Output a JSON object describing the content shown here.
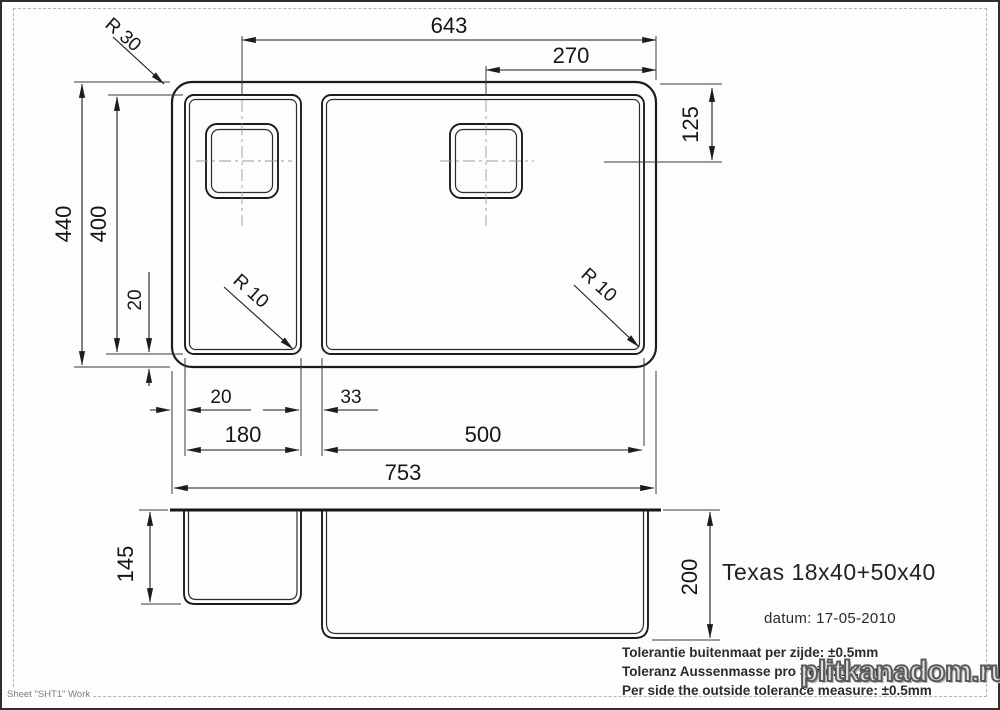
{
  "drawing": {
    "title": "Texas 18x40+50x40",
    "date_label": "datum: 17-05-2010",
    "tolerances": {
      "line_nl": "Tolerantie buitenmaat per zijde: ±0.5mm",
      "line_de": "Toleranz Aussenmasse pro Seite: ±0.5mm",
      "line_en": "Per side the outside tolerance measure: ±0.5mm"
    },
    "sheet_label": "Sheet \"SHT1\" Work",
    "watermark": "plitkanadom.ru",
    "colors": {
      "line": "#1c1c1c",
      "centerline": "#9a9a9a",
      "frame_dash": "#b5b5b5",
      "watermark_fill": "#dedede",
      "watermark_stroke": "#5a5a5a"
    },
    "dims": {
      "width_643": "643",
      "width_270": "270",
      "hole_offset_125": "125",
      "outer_depth_440": "440",
      "bowl_depth_400": "400",
      "rim_20_vertical": "20",
      "radius_outer_30": "R 30",
      "radius_bowl_left_10": "R 10",
      "radius_bowl_right_10": "R 10",
      "rim_20_horizontal": "20",
      "divider_33": "33",
      "left_bowl_width_180": "180",
      "right_bowl_width_500": "500",
      "outer_width_753": "753",
      "left_bowl_height_145": "145",
      "right_bowl_height_200": "200"
    }
  }
}
